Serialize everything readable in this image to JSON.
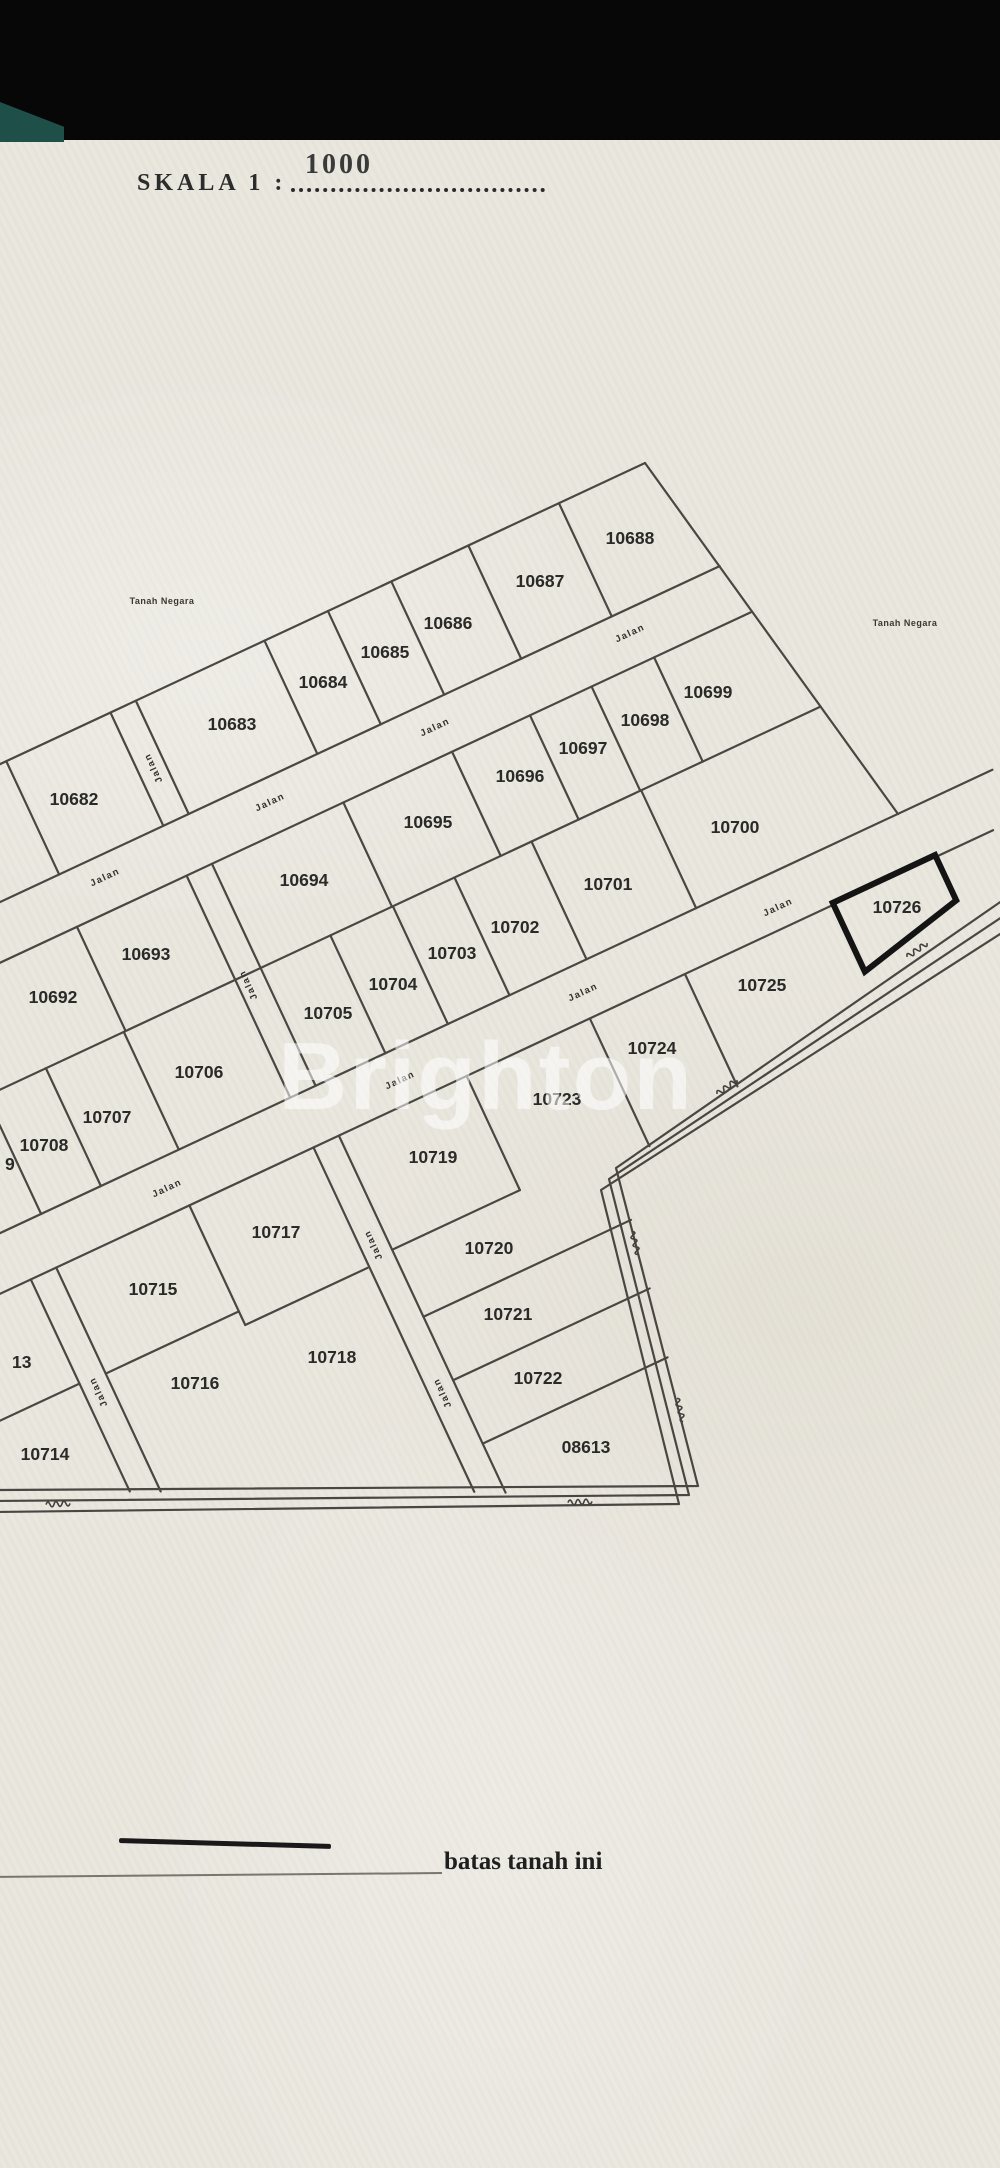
{
  "page": {
    "title_prefix": "SKALA 1 :",
    "title_value": "1000",
    "watermark": "Brighton",
    "legend_label": "batas tanah ini"
  },
  "map": {
    "road_label": "Jalan",
    "land_note": "Tanah Negara",
    "target_parcel": "10726",
    "line_color": "#3c3a36",
    "label_color": "#2a2a28",
    "parcels": [
      {
        "no": "10682",
        "x": 74,
        "y": 799
      },
      {
        "no": "10683",
        "x": 232,
        "y": 724
      },
      {
        "no": "10684",
        "x": 323,
        "y": 682
      },
      {
        "no": "10685",
        "x": 385,
        "y": 652
      },
      {
        "no": "10686",
        "x": 448,
        "y": 623
      },
      {
        "no": "10687",
        "x": 540,
        "y": 581
      },
      {
        "no": "10688",
        "x": 630,
        "y": 538
      },
      {
        "no": "10692",
        "x": 53,
        "y": 997
      },
      {
        "no": "10693",
        "x": 146,
        "y": 954
      },
      {
        "no": "10694",
        "x": 304,
        "y": 880
      },
      {
        "no": "10695",
        "x": 428,
        "y": 822
      },
      {
        "no": "10696",
        "x": 520,
        "y": 776
      },
      {
        "no": "10697",
        "x": 583,
        "y": 748
      },
      {
        "no": "10698",
        "x": 645,
        "y": 720
      },
      {
        "no": "10699",
        "x": 708,
        "y": 692
      },
      {
        "no": "10700",
        "x": 735,
        "y": 827
      },
      {
        "no": "10701",
        "x": 608,
        "y": 884
      },
      {
        "no": "10702",
        "x": 515,
        "y": 927
      },
      {
        "no": "10703",
        "x": 452,
        "y": 953
      },
      {
        "no": "10704",
        "x": 393,
        "y": 984
      },
      {
        "no": "10705",
        "x": 328,
        "y": 1013
      },
      {
        "no": "10706",
        "x": 199,
        "y": 1072
      },
      {
        "no": "10707",
        "x": 107,
        "y": 1117
      },
      {
        "no": "10708",
        "x": 44,
        "y": 1145
      },
      {
        "no": "10714",
        "x": 45,
        "y": 1454
      },
      {
        "no": "10715",
        "x": 153,
        "y": 1289
      },
      {
        "no": "10716",
        "x": 195,
        "y": 1383
      },
      {
        "no": "10717",
        "x": 276,
        "y": 1232
      },
      {
        "no": "10718",
        "x": 332,
        "y": 1357
      },
      {
        "no": "10719",
        "x": 433,
        "y": 1157
      },
      {
        "no": "10720",
        "x": 489,
        "y": 1248
      },
      {
        "no": "10721",
        "x": 508,
        "y": 1314
      },
      {
        "no": "10722",
        "x": 538,
        "y": 1378
      },
      {
        "no": "10723",
        "x": 557,
        "y": 1099
      },
      {
        "no": "10724",
        "x": 652,
        "y": 1048
      },
      {
        "no": "10725",
        "x": 762,
        "y": 985
      },
      {
        "no": "10726",
        "x": 897,
        "y": 907,
        "bold": true
      },
      {
        "no": "08613",
        "x": 586,
        "y": 1447
      }
    ],
    "partial_labels": [
      {
        "text": "9",
        "x": 5,
        "y": 1164
      },
      {
        "text": "13",
        "x": 12,
        "y": 1362
      }
    ],
    "road_labels": [
      {
        "x": 105,
        "y": 877,
        "angle": -25
      },
      {
        "x": 270,
        "y": 802,
        "angle": -25
      },
      {
        "x": 435,
        "y": 727,
        "angle": -25
      },
      {
        "x": 630,
        "y": 633,
        "angle": -25
      },
      {
        "x": 153,
        "y": 768,
        "angle": -115
      },
      {
        "x": 248,
        "y": 985,
        "angle": -115
      },
      {
        "x": 167,
        "y": 1188,
        "angle": -25
      },
      {
        "x": 400,
        "y": 1080,
        "angle": -25
      },
      {
        "x": 583,
        "y": 992,
        "angle": -25
      },
      {
        "x": 778,
        "y": 907,
        "angle": -25
      },
      {
        "x": 373,
        "y": 1245,
        "angle": -115
      },
      {
        "x": 442,
        "y": 1393,
        "angle": -115
      },
      {
        "x": 98,
        "y": 1392,
        "angle": -115
      }
    ],
    "land_notes": [
      {
        "x": 162,
        "y": 601
      },
      {
        "x": 905,
        "y": 623
      }
    ],
    "road_marks": [
      {
        "x": 727,
        "y": 1087,
        "angle": -35
      },
      {
        "x": 917,
        "y": 950,
        "angle": -35
      },
      {
        "x": 635,
        "y": 1243,
        "angle": 75
      },
      {
        "x": 680,
        "y": 1410,
        "angle": 75
      },
      {
        "x": 580,
        "y": 1502,
        "angle": -3
      },
      {
        "x": 58,
        "y": 1504,
        "angle": -3
      }
    ]
  }
}
